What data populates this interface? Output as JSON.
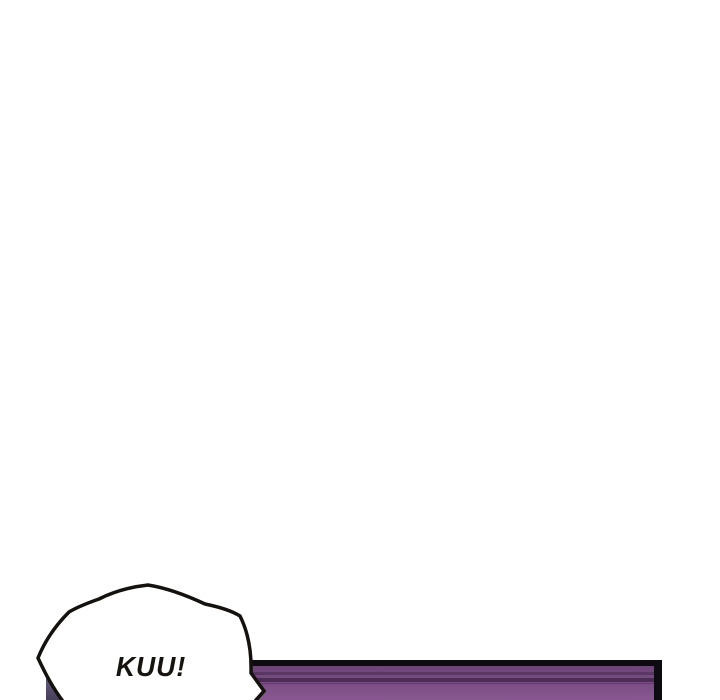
{
  "scene": {
    "type": "webtoon-comic-strip-segment",
    "background_color": "#ffffff",
    "speech_bubble": {
      "text": "KUU!",
      "style": "spiky-shout-bubble",
      "fill": "#ffffff",
      "outline_color": "#14110e",
      "text_color": "#17140f"
    },
    "panel": {
      "description": "top edge of purple comic panel cut off by bottom of image",
      "border_color": "#0d0b11",
      "fill_top": "#6d4477",
      "fill_bottom": "#8d5b96",
      "stripe_colors": [
        "#593663",
        "#4a2c55",
        "#613c6c"
      ],
      "corner_shadow_top": "#6b6287",
      "corner_shadow_bottom": "#474059"
    }
  }
}
